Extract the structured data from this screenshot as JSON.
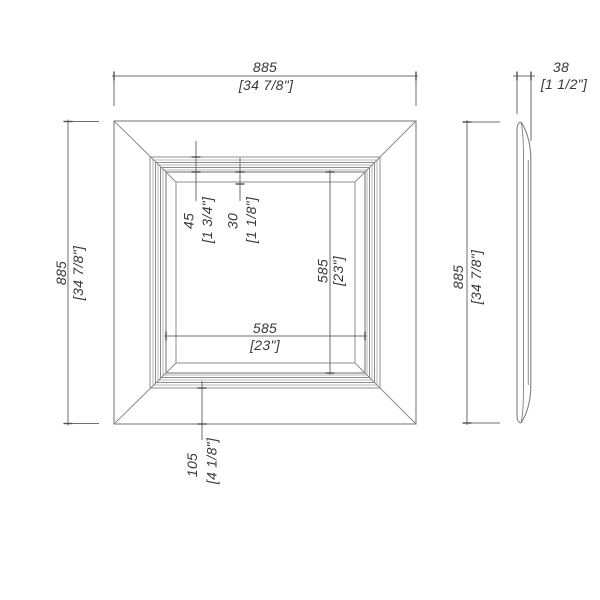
{
  "front_view": {
    "overall_width": {
      "mm": "885",
      "inch": "[34 7/8\"]"
    },
    "overall_height": {
      "mm": "885",
      "inch": "[34 7/8\"]"
    },
    "opening_width": {
      "mm": "585",
      "inch": "[23\"]"
    },
    "opening_height": {
      "mm": "585",
      "inch": "[23\"]"
    },
    "moulding_width": {
      "mm": "45",
      "inch": "[1 3/4\"]"
    },
    "bevel_width": {
      "mm": "30",
      "inch": "[1 1/8\"]"
    },
    "face_width": {
      "mm": "105",
      "inch": "[4 1/8\"]"
    }
  },
  "side_view": {
    "depth": {
      "mm": "38",
      "inch": "[1 1/2\"]"
    },
    "height": {
      "mm": "885",
      "inch": "[34 7/8\"]"
    }
  },
  "colors": {
    "line": "#8c8c8c",
    "dimension": "#6e6e6e",
    "text": "#383838",
    "background": "#ffffff"
  }
}
